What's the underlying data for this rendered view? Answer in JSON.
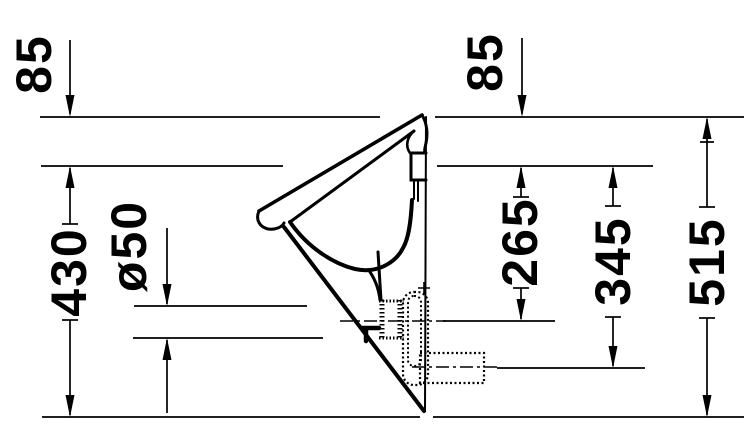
{
  "drawing": {
    "kind": "technical-dimension-drawing",
    "subject": "wall-mounted conical urinal, side profile with outlet variants",
    "units": "mm",
    "colors": {
      "line": "#000000",
      "background": "#ffffff"
    },
    "dimensions": {
      "offset_left": "85",
      "offset_right": "85",
      "front_height": "430",
      "outlet_diameter": "ø50",
      "outlet_center_from_rim": "265",
      "trap_outlet_center_from_rim": "345",
      "overall_height": "515"
    }
  }
}
